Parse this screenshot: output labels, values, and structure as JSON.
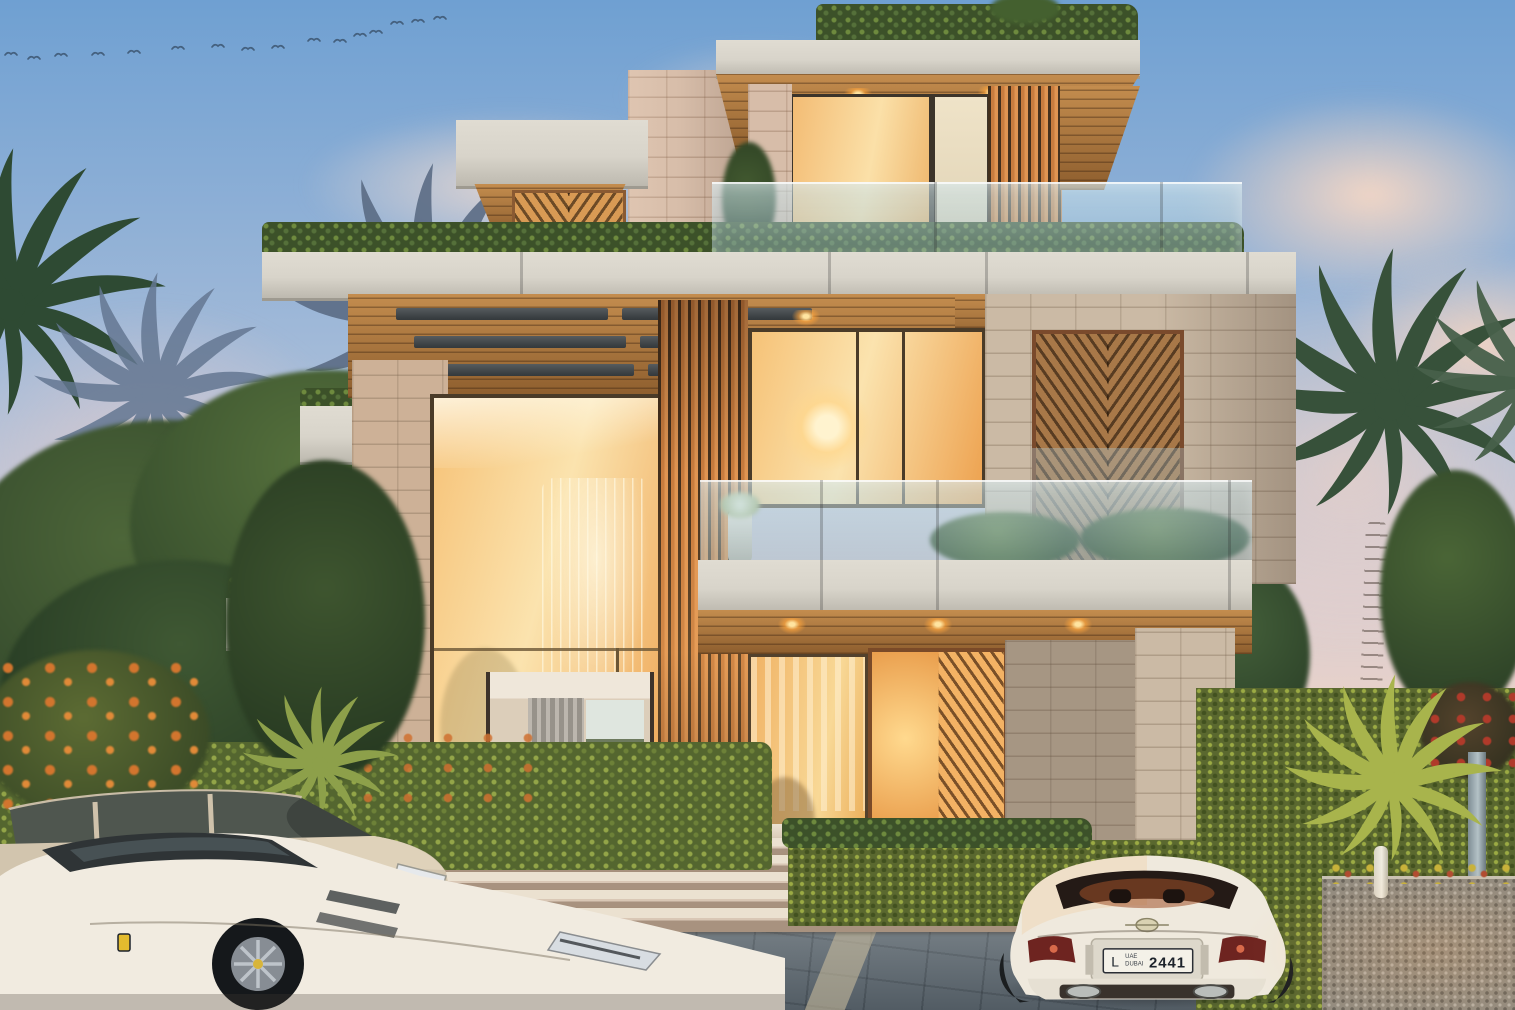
{
  "scene": {
    "type": "architectural-render",
    "setting": "Modern three-storey luxury villa at dusk with stone cladding, wood louver screens, glass balustrades, roof gardens, landscaped driveway and parked luxury cars",
    "location_hint": "Dubai",
    "time_of_day": "dusk"
  },
  "sky": {
    "description": "blue sky fading to pink horizon with soft clouds and a flock of birds",
    "birds": [
      [
        5,
        52
      ],
      [
        28,
        56
      ],
      [
        55,
        53
      ],
      [
        92,
        52
      ],
      [
        128,
        50
      ],
      [
        172,
        46
      ],
      [
        212,
        44
      ],
      [
        242,
        47
      ],
      [
        272,
        45
      ],
      [
        308,
        38
      ],
      [
        334,
        39
      ],
      [
        354,
        33
      ],
      [
        370,
        30
      ],
      [
        391,
        21
      ],
      [
        412,
        19
      ],
      [
        434,
        16
      ]
    ]
  },
  "license_plate": {
    "letter": "L",
    "country": "UAE",
    "emirate": "DUBAI",
    "number": "2441"
  },
  "vehicles": [
    {
      "type": "champagne SUV",
      "position": "left, behind sports car"
    },
    {
      "type": "white sports car",
      "position": "front left"
    },
    {
      "type": "white coupe (rear view)",
      "position": "right",
      "plate": "L UAE DUBAI 2441"
    }
  ],
  "colors": {
    "sky_top": "#6fa0d2",
    "sky_mid": "#aabed9",
    "sky_horizon": "#f4d5c3",
    "cloud": "#f7ded0",
    "concrete": "#d8d4ca",
    "wood": "#b0793d",
    "louver": "#c87c3e",
    "louver_gap": "#43301d",
    "stone_tan": "#cbbaa5",
    "stone_pink": "#d7bda9",
    "glass_warm": "#f6c277",
    "glass_warm_deep": "#eda14e",
    "foliage": "#3c5129",
    "foliage_light": "#6e8a3e",
    "ivy": "#5a682f",
    "paving": "#6e7981",
    "car_white": "#f0eadf",
    "car_champagne": "#cfc2ab",
    "plate_bg": "#f4f1e8"
  }
}
